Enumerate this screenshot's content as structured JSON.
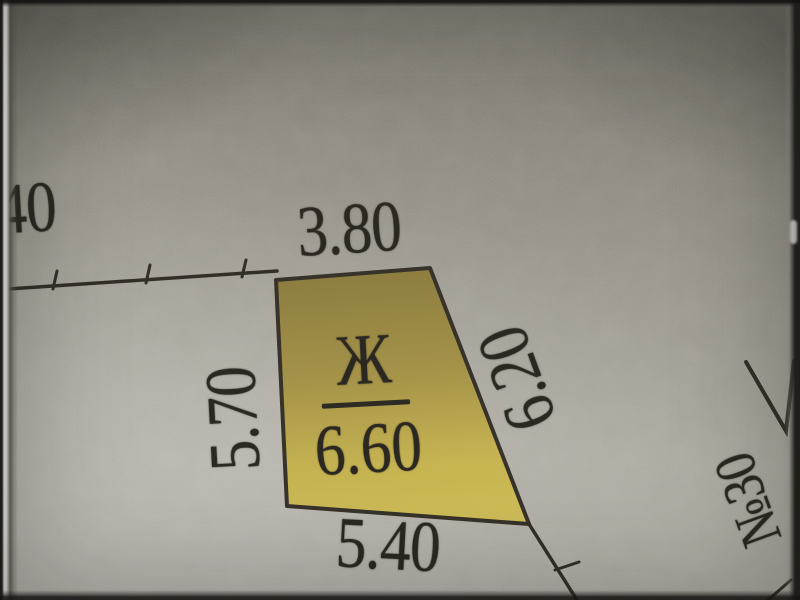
{
  "plan": {
    "parcel": {
      "label": "Ж",
      "value": "6.60"
    },
    "dimensions": {
      "top": "3.80",
      "left": "5.70",
      "right": "6.20",
      "bottom": "5.40"
    },
    "neighbor_dimension_fragment": "40",
    "neighbor_parcel_number": "№30"
  },
  "colors": {
    "ink": "#2b2721",
    "parcel_fill_dark": "#8a7b3f",
    "parcel_fill_light": "#d0be59",
    "paper_dark": "#6f6b62",
    "paper_light": "#b2afa7"
  }
}
